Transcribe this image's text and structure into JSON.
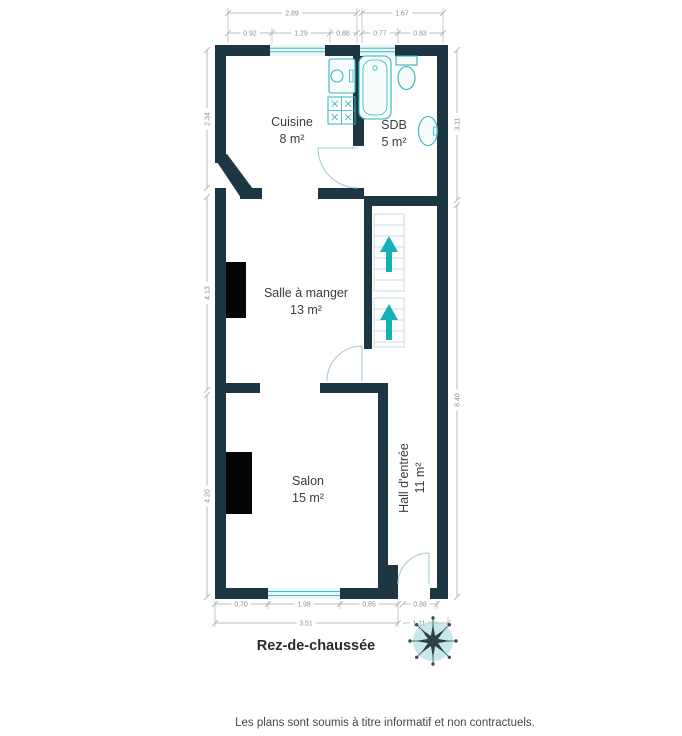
{
  "title": "Rez-de-chaussée",
  "disclaimer": "Les plans sont soumis à titre informatif et non contractuels.",
  "rooms": [
    {
      "name": "Cuisine",
      "area": "8 m²"
    },
    {
      "name": "SDB",
      "area": "5 m²"
    },
    {
      "name": "Salle à manger",
      "area": "13 m²"
    },
    {
      "name": "Salon",
      "area": "15 m²"
    },
    {
      "name": "Hall d'entrée",
      "area": "11 m²"
    }
  ],
  "dimensions": {
    "top": [
      "2.89",
      "1.67"
    ],
    "top_detail": [
      "0.92",
      "1.29",
      "0.88",
      "0.77",
      "0.83"
    ],
    "left": [
      "2.34",
      "4.13",
      "4.20"
    ],
    "right": [
      "3.11",
      "8.40"
    ],
    "bottom_detail": [
      "0.70",
      "1.98",
      "0.85",
      "0.88"
    ],
    "bottom": [
      "3.51",
      "1.11"
    ]
  },
  "icons": {
    "compass": "compass-rose",
    "stairs_arrows": "up-arrow",
    "fixtures": [
      "kitchen-sink",
      "stove",
      "bathtub",
      "toilet",
      "washbasin"
    ],
    "fireplaces": 2
  },
  "colors": {
    "wall": "#1d3644",
    "fixture": "#2eb4ba",
    "window_fill": "#e9f7f7",
    "stairs_arrow": "#12b2b8",
    "dimension_line": "#a8a8a8",
    "dimension_text": "#8f8f8f",
    "room_text": "#3c3c3c",
    "fireplace": "#050505"
  }
}
